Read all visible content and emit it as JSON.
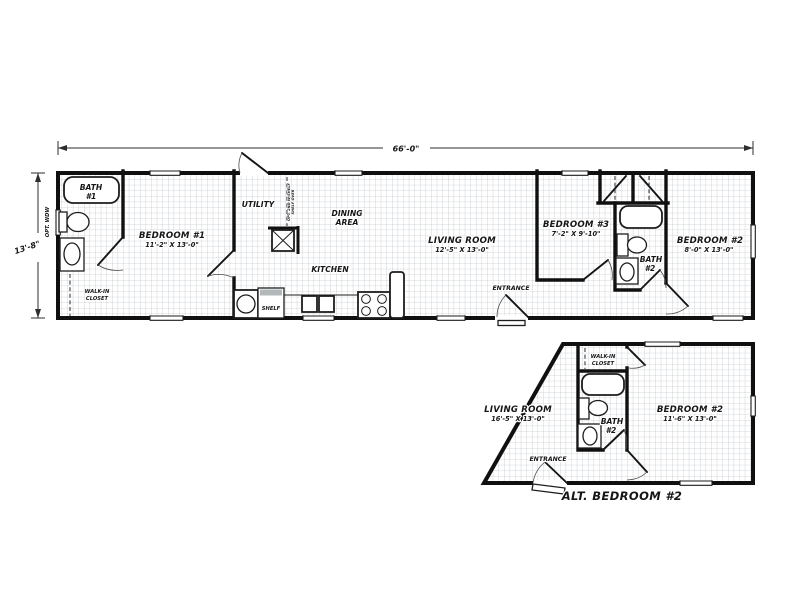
{
  "plan": {
    "colors": {
      "wall": "#101010",
      "grid": "#c4cad0",
      "text": "#161616",
      "background": "#ffffff"
    },
    "dim_width": "66'-0\"",
    "dim_height": "13'-8\"",
    "main": {
      "bath1": {
        "line1": "BATH",
        "line2": "#1"
      },
      "opt_window": "OPT. WDW",
      "walk_in_closet": {
        "line1": "WALK-IN",
        "line2": "CLOSET"
      },
      "bedroom1": {
        "name": "BEDROOM #1",
        "size": "11'-2\" X 13'-0\""
      },
      "utility": {
        "label": "UTILITY",
        "note_line1": "SHELF OVER",
        "note_line2": "OPT. 2ND W/SHELF"
      },
      "dining": {
        "line1": "DINING",
        "line2": "AREA"
      },
      "kitchen": {
        "label": "KITCHEN",
        "shelf": "SHELF"
      },
      "living": {
        "name": "LIVING ROOM",
        "size": "12'-5\" X 13'-0\""
      },
      "entrance": "ENTRANCE",
      "bedroom3": {
        "name": "BEDROOM #3",
        "size": "7'-2\" X 9'-10\""
      },
      "bath2": {
        "line1": "BATH",
        "line2": "#2"
      },
      "bedroom2": {
        "name": "BEDROOM #2",
        "size": "8'-0\" X 13'-0\""
      }
    },
    "alt": {
      "walk_in_closet": {
        "line1": "WALK-IN",
        "line2": "CLOSET"
      },
      "living": {
        "name": "LIVING ROOM",
        "size": "16'-5\" X 13'-0\""
      },
      "bath2": {
        "line1": "BATH",
        "line2": "#2"
      },
      "bedroom2": {
        "name": "BEDROOM #2",
        "size": "11'-6\" X 13'-0\""
      },
      "entrance": "ENTRANCE",
      "caption": "ALT. BEDROOM #2"
    }
  }
}
